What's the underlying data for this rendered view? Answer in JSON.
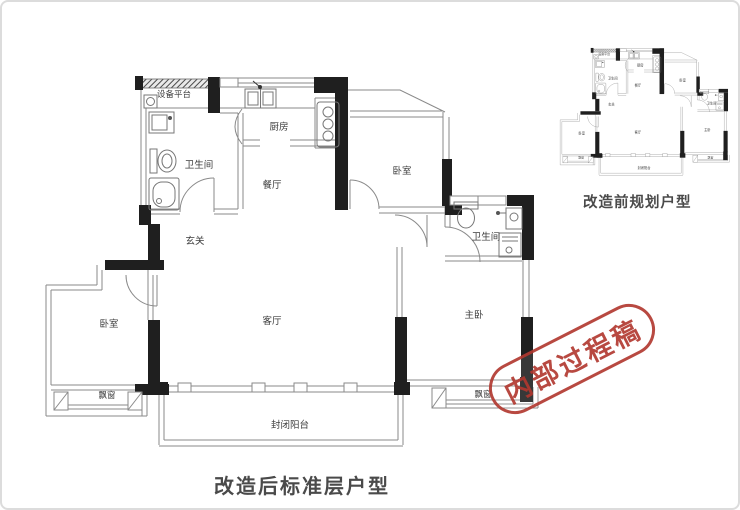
{
  "page": {
    "background": "#ffffff",
    "border_color": "#dcdcdc"
  },
  "main_plan": {
    "caption": "改造后标准层户型",
    "rooms": {
      "equipment_platform": {
        "label": "设备平台"
      },
      "bathroom_left": {
        "label": "卫生间"
      },
      "kitchen": {
        "label": "厨房"
      },
      "dining": {
        "label": "餐厅"
      },
      "entry": {
        "label": "玄关"
      },
      "bedroom_top": {
        "label": "卧室"
      },
      "bathroom_right": {
        "label": "卫生间"
      },
      "bedroom_left": {
        "label": "卧室"
      },
      "living": {
        "label": "客厅"
      },
      "master_bedroom": {
        "label": "主卧"
      },
      "bay_window_left": {
        "label": "飘窗"
      },
      "bay_window_right": {
        "label": "飘窗"
      },
      "balcony": {
        "label": "封闭阳台"
      }
    }
  },
  "small_plan": {
    "caption": "改造前规划户型"
  },
  "stamp": {
    "text": "内部过程稿",
    "color": "#b23a31"
  },
  "colors": {
    "wall_thin": "#8a8a8a",
    "wall_black": "#1f1f1f",
    "fixture": "#777777",
    "label_text": "#3c3c3c",
    "caption_text": "#4a4a4a"
  }
}
